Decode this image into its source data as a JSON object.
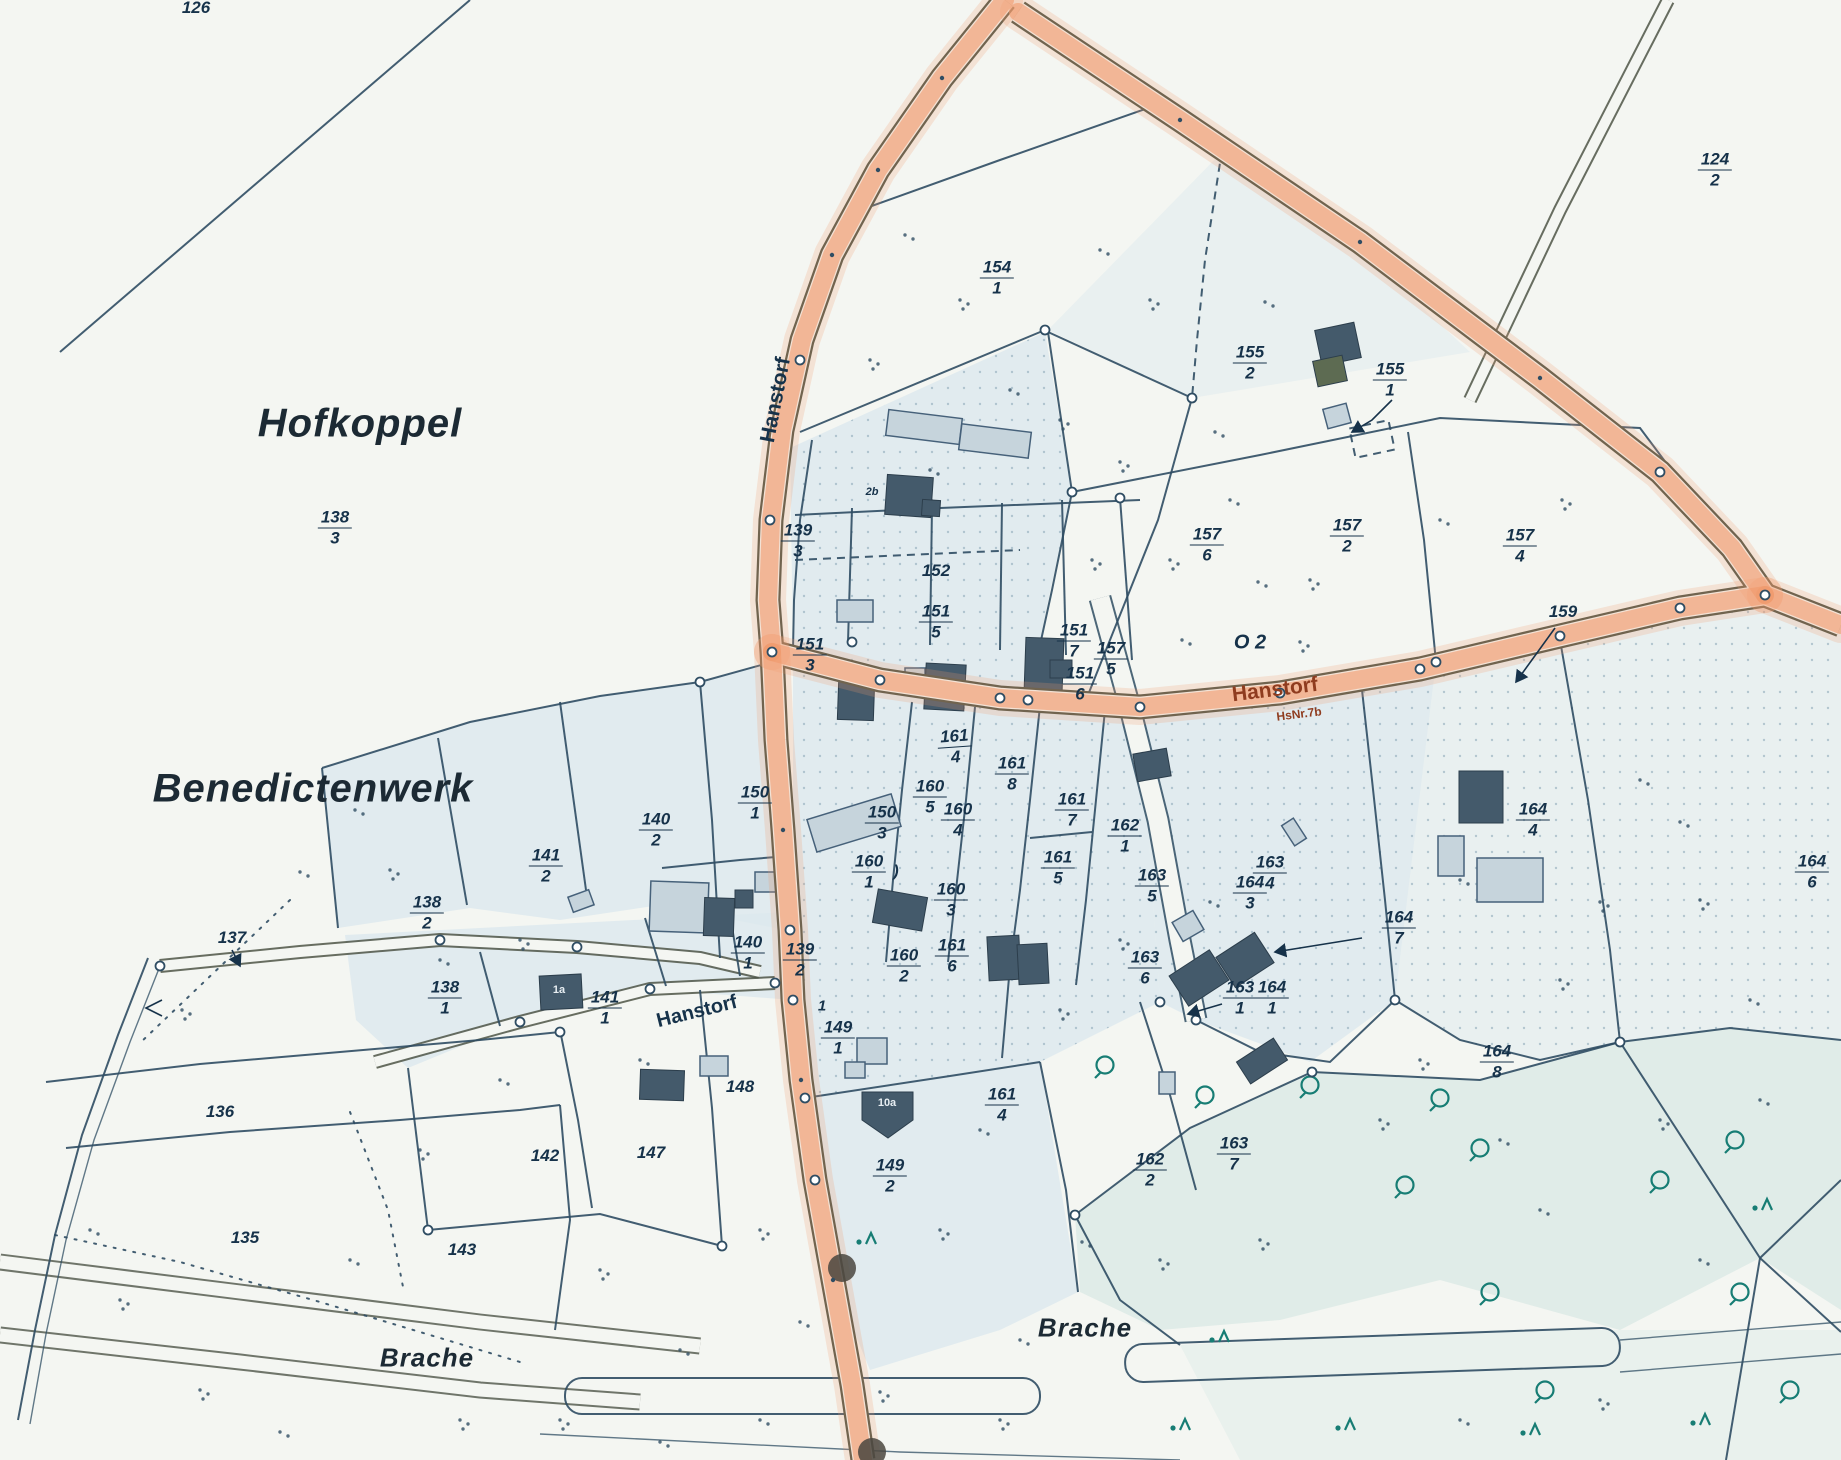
{
  "map": {
    "colors": {
      "paper": "#f4f6f2",
      "line": "#2f4d63",
      "text": "#16324a",
      "casing": "#4d5547",
      "orange": "#f0996c",
      "red": "#8f3c1f",
      "tint": "#dce8ee",
      "teal": "#177d74",
      "tealfill": "#cfe3e0",
      "building_dark": "#445a6b",
      "building_light": "#c6d4dc"
    },
    "region_names": [
      {
        "text": "Hofkoppel",
        "x": 360,
        "y": 424,
        "size": 40,
        "r": 0
      },
      {
        "text": "Benedictenwerk",
        "x": 313,
        "y": 789,
        "size": 40,
        "r": 0
      },
      {
        "text": "Brache",
        "x": 427,
        "y": 1358,
        "size": 26,
        "r": 0
      },
      {
        "text": "Brache",
        "x": 1085,
        "y": 1328,
        "size": 26,
        "r": 0
      }
    ],
    "street_labels": [
      {
        "text": "Hanstorf",
        "x": 776,
        "y": 400,
        "size": 21,
        "r": -79,
        "red": false
      },
      {
        "text": "Hanstorf",
        "x": 1275,
        "y": 690,
        "size": 21,
        "r": -7,
        "red": true
      },
      {
        "text": "HsNr.7b",
        "x": 1299,
        "y": 714,
        "size": 12,
        "r": -7,
        "red": true
      },
      {
        "text": "Hanstorf",
        "x": 697,
        "y": 1012,
        "size": 20,
        "r": -14,
        "red": false
      }
    ],
    "parcel_labels": [
      {
        "main": "126",
        "x": 196,
        "y": 8
      },
      {
        "main": "138",
        "sub": "3",
        "x": 335,
        "y": 528
      },
      {
        "main": "124",
        "sub": "2",
        "x": 1715,
        "y": 170
      },
      {
        "main": "154",
        "sub": "1",
        "x": 997,
        "y": 278
      },
      {
        "main": "155",
        "sub": "2",
        "x": 1250,
        "y": 363
      },
      {
        "main": "155",
        "sub": "1",
        "x": 1390,
        "y": 380
      },
      {
        "main": "157",
        "sub": "6",
        "x": 1207,
        "y": 545
      },
      {
        "main": "157",
        "sub": "2",
        "x": 1347,
        "y": 536
      },
      {
        "main": "157",
        "sub": "4",
        "x": 1520,
        "y": 546
      },
      {
        "main": "159",
        "x": 1563,
        "y": 612
      },
      {
        "main": "152",
        "x": 936,
        "y": 571
      },
      {
        "main": "139",
        "sub": "3",
        "x": 798,
        "y": 541
      },
      {
        "main": "151",
        "sub": "3",
        "x": 810,
        "y": 655
      },
      {
        "main": "151",
        "sub": "5",
        "x": 936,
        "y": 622
      },
      {
        "main": "151",
        "sub": "7",
        "x": 1074,
        "y": 641
      },
      {
        "main": "157",
        "sub": "5",
        "x": 1111,
        "y": 659
      },
      {
        "main": "151",
        "sub": "6",
        "x": 1080,
        "y": 684
      },
      {
        "main": "150",
        "sub": "1",
        "x": 755,
        "y": 803
      },
      {
        "main": "150",
        "sub": "3",
        "x": 882,
        "y": 823
      },
      {
        "main": "160",
        "sub": "5",
        "x": 930,
        "y": 797
      },
      {
        "main": "160",
        "sub": "4",
        "x": 958,
        "y": 820
      },
      {
        "main": "160",
        "sub": "1",
        "x": 869,
        "y": 872
      },
      {
        "main": "161",
        "sub": "8",
        "x": 1012,
        "y": 774
      },
      {
        "main": "161",
        "sub": "4",
        "x": 955,
        "y": 747,
        "r": -4
      },
      {
        "main": "161",
        "sub": "7",
        "x": 1072,
        "y": 810
      },
      {
        "main": "161",
        "sub": "5",
        "x": 1058,
        "y": 868
      },
      {
        "main": "162",
        "sub": "1",
        "x": 1125,
        "y": 836
      },
      {
        "main": "160",
        "sub": "2",
        "x": 904,
        "y": 966
      },
      {
        "main": "161",
        "sub": "6",
        "x": 952,
        "y": 956
      },
      {
        "main": "160",
        "sub": "3",
        "x": 951,
        "y": 900
      },
      {
        "main": "140",
        "sub": "2",
        "x": 656,
        "y": 830
      },
      {
        "main": "141",
        "sub": "2",
        "x": 546,
        "y": 866
      },
      {
        "main": "138",
        "sub": "2",
        "x": 427,
        "y": 913
      },
      {
        "main": "141",
        "sub": "1",
        "x": 605,
        "y": 1008
      },
      {
        "main": "138",
        "sub": "1",
        "x": 445,
        "y": 998
      },
      {
        "main": "140",
        "sub": "1",
        "x": 748,
        "y": 953
      },
      {
        "main": "139",
        "sub": "2",
        "x": 800,
        "y": 960
      },
      {
        "main": "149",
        "sub": "1",
        "x": 838,
        "y": 1038
      },
      {
        "main": "161",
        "sub": "4",
        "x": 1002,
        "y": 1105
      },
      {
        "main": "149",
        "sub": "2",
        "x": 890,
        "y": 1176
      },
      {
        "main": "162",
        "sub": "2",
        "x": 1150,
        "y": 1170
      },
      {
        "main": "163",
        "sub": "4",
        "x": 1270,
        "y": 873
      },
      {
        "main": "163",
        "sub": "5",
        "x": 1152,
        "y": 886
      },
      {
        "main": "163",
        "sub": "6",
        "x": 1145,
        "y": 968
      },
      {
        "main": "163",
        "sub": "1",
        "x": 1240,
        "y": 998
      },
      {
        "main": "164",
        "sub": "1",
        "x": 1272,
        "y": 998
      },
      {
        "main": "164",
        "sub": "3",
        "x": 1250,
        "y": 893
      },
      {
        "main": "164",
        "sub": "7",
        "x": 1399,
        "y": 928
      },
      {
        "main": "164",
        "sub": "8",
        "x": 1497,
        "y": 1062
      },
      {
        "main": "164",
        "sub": "4",
        "x": 1533,
        "y": 820
      },
      {
        "main": "164",
        "sub": "6",
        "x": 1812,
        "y": 872
      },
      {
        "main": "163",
        "sub": "7",
        "x": 1234,
        "y": 1154
      },
      {
        "main": "147",
        "x": 651,
        "y": 1153
      },
      {
        "main": "148",
        "x": 740,
        "y": 1087
      },
      {
        "main": "142",
        "x": 545,
        "y": 1156
      },
      {
        "main": "143",
        "x": 462,
        "y": 1250
      },
      {
        "main": "135",
        "x": 245,
        "y": 1238
      },
      {
        "main": "136",
        "x": 220,
        "y": 1112
      },
      {
        "main": "137",
        "x": 232,
        "y": 938
      }
    ],
    "notes": [
      {
        "text": "O 2",
        "x": 1250,
        "y": 643,
        "size": 20,
        "light": false
      },
      {
        "text": "1",
        "x": 822,
        "y": 1006,
        "size": 15,
        "light": false
      },
      {
        "text": "2b",
        "x": 872,
        "y": 492,
        "size": 11,
        "light": false
      },
      {
        "text": "1a",
        "x": 559,
        "y": 990,
        "size": 11,
        "light": true
      },
      {
        "text": "10a",
        "x": 887,
        "y": 1103,
        "size": 11,
        "light": true
      },
      {
        "text": ")",
        "x": 896,
        "y": 872,
        "size": 16,
        "light": false
      }
    ],
    "vegetation_marks": [
      [
        905,
        235
      ],
      [
        960,
        300
      ],
      [
        1010,
        390
      ],
      [
        870,
        360
      ],
      [
        1100,
        250
      ],
      [
        1060,
        420
      ],
      [
        930,
        470
      ],
      [
        1150,
        300
      ],
      [
        1215,
        432
      ],
      [
        1120,
        462
      ],
      [
        1265,
        302
      ],
      [
        1170,
        560
      ],
      [
        1258,
        582
      ],
      [
        1092,
        560
      ],
      [
        1230,
        500
      ],
      [
        1310,
        580
      ],
      [
        1182,
        640
      ],
      [
        1300,
        642
      ],
      [
        1440,
        520
      ],
      [
        1562,
        500
      ],
      [
        1640,
        780
      ],
      [
        1700,
        900
      ],
      [
        1750,
        1000
      ],
      [
        1600,
        902
      ],
      [
        1680,
        822
      ],
      [
        1560,
        980
      ],
      [
        1460,
        880
      ],
      [
        1420,
        1060
      ],
      [
        1500,
        1140
      ],
      [
        1060,
        1010
      ],
      [
        980,
        1130
      ],
      [
        940,
        1230
      ],
      [
        1082,
        1242
      ],
      [
        1160,
        1260
      ],
      [
        1020,
        1340
      ],
      [
        880,
        1392
      ],
      [
        800,
        1322
      ],
      [
        760,
        1230
      ],
      [
        355,
        810
      ],
      [
        390,
        870
      ],
      [
        300,
        872
      ],
      [
        182,
        1010
      ],
      [
        440,
        960
      ],
      [
        520,
        940
      ],
      [
        500,
        1080
      ],
      [
        420,
        1150
      ],
      [
        640,
        1060
      ],
      [
        600,
        1270
      ],
      [
        680,
        1350
      ],
      [
        560,
        1420
      ],
      [
        760,
        1420
      ],
      [
        460,
        1420
      ],
      [
        350,
        1260
      ],
      [
        200,
        1390
      ],
      [
        280,
        1432
      ],
      [
        120,
        1300
      ],
      [
        660,
        1442
      ],
      [
        1000,
        1420
      ],
      [
        90,
        1230
      ],
      [
        1120,
        940
      ],
      [
        1210,
        902
      ],
      [
        1660,
        1120
      ],
      [
        1540,
        1210
      ],
      [
        1380,
        1120
      ],
      [
        1700,
        1260
      ],
      [
        1600,
        1400
      ],
      [
        1460,
        1420
      ],
      [
        1260,
        1240
      ],
      [
        1760,
        1100
      ]
    ],
    "trees_broadleaf": [
      [
        1205,
        1095
      ],
      [
        1310,
        1085
      ],
      [
        1440,
        1098
      ],
      [
        1480,
        1148
      ],
      [
        1660,
        1180
      ],
      [
        1735,
        1140
      ],
      [
        1740,
        1292
      ],
      [
        1790,
        1390
      ],
      [
        1545,
        1390
      ],
      [
        1405,
        1185
      ],
      [
        1490,
        1292
      ],
      [
        1105,
        1065
      ]
    ],
    "trees_conifer": [
      [
        866,
        1244
      ],
      [
        1219,
        1342
      ],
      [
        1345,
        1430
      ],
      [
        1530,
        1435
      ],
      [
        1700,
        1425
      ],
      [
        1180,
        1430
      ],
      [
        1762,
        1210
      ]
    ],
    "road_dots": [
      [
        842,
        1268
      ],
      [
        872,
        1452
      ]
    ]
  }
}
